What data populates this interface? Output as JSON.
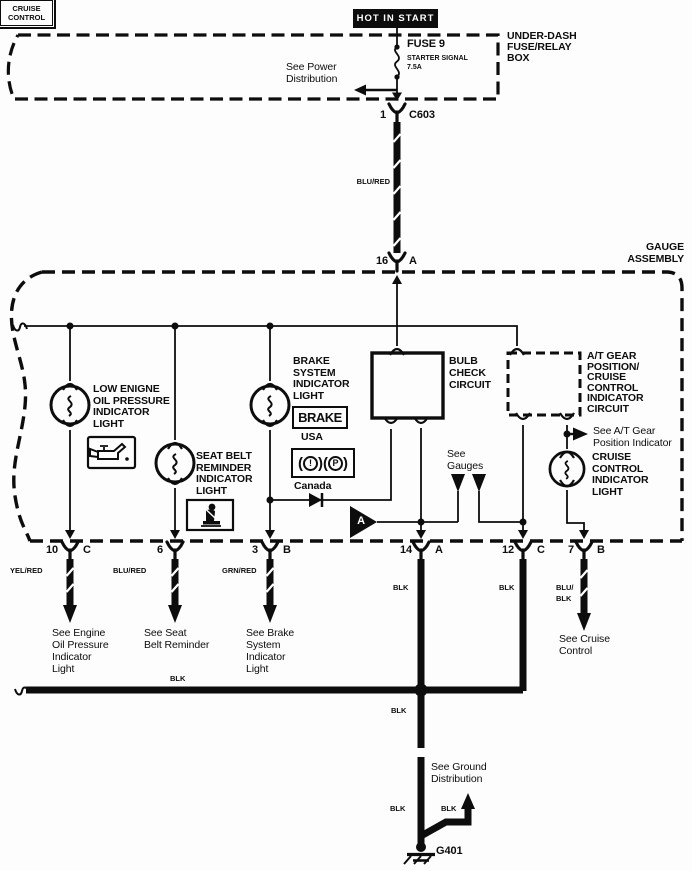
{
  "colors": {
    "ink": "#0d0d0d",
    "paper": "#fdfdfd"
  },
  "power": {
    "source": "HOT IN START",
    "see": "See Power\nDistribution"
  },
  "fuse_box": {
    "label": "UNDER-DASH\nFUSE/RELAY\nBOX",
    "fuse_name": "FUSE 9",
    "fuse_desc": "STARTER SIGNAL",
    "fuse_rating": "7.5A",
    "pin": "1",
    "connector": "C603"
  },
  "feed": {
    "wire": "BLU/RED",
    "pin": "16",
    "cavity": "A"
  },
  "gauge": {
    "label": "GAUGE\nASSEMBLY",
    "oil": {
      "name": "LOW ENIGNE\nOIL PRESSURE\nINDICATOR\nLIGHT"
    },
    "seat": {
      "name": "SEAT BELT\nREMINDER\nINDICATOR\nLIGHT"
    },
    "brake": {
      "name": "BRAKE\nSYSTEM\nINDICATOR\nLIGHT",
      "badge": "BRAKE",
      "usa": "USA",
      "canada": "Canada",
      "intl": {
        "open": "(",
        "close": ")",
        "s1": "!",
        "s2": "P"
      }
    },
    "bulb_check": "BULB\nCHECK\nCIRCUIT",
    "at_circuit": "A/T GEAR\nPOSITION/\nCRUISE\nCONTROL\nINDICATOR\nCIRCUIT",
    "see_at": "See A/T Gear\nPosition Indicator",
    "cruise": {
      "name": "CRUISE\nCONTROL\nINDICATOR\nLIGHT",
      "badge": "CRUISE\nCONTROL"
    },
    "see_gauges": "See\nGauges",
    "ref_a": "A"
  },
  "pins": [
    {
      "num": "10",
      "cav": "C",
      "wire": "YEL/RED",
      "see": "See Engine\nOil Pressure\nIndicator\nLight"
    },
    {
      "num": "6",
      "cav": "",
      "wire": "BLU/RED",
      "see": "See Seat\nBelt Reminder"
    },
    {
      "num": "3",
      "cav": "B",
      "wire": "GRN/RED",
      "see": "See Brake\nSystem\nIndicator\nLight"
    },
    {
      "num": "14",
      "cav": "A",
      "wire": "BLK"
    },
    {
      "num": "12",
      "cav": "C",
      "wire": "BLK"
    },
    {
      "num": "7",
      "cav": "B",
      "wire": "BLU/\nBLK",
      "see": "See Cruise\nControl"
    }
  ],
  "ground": {
    "bus_wire": "BLK",
    "down1": "BLK",
    "down2": "BLK",
    "branch": "BLK",
    "see": "See Ground\nDistribution",
    "id": "G401"
  }
}
